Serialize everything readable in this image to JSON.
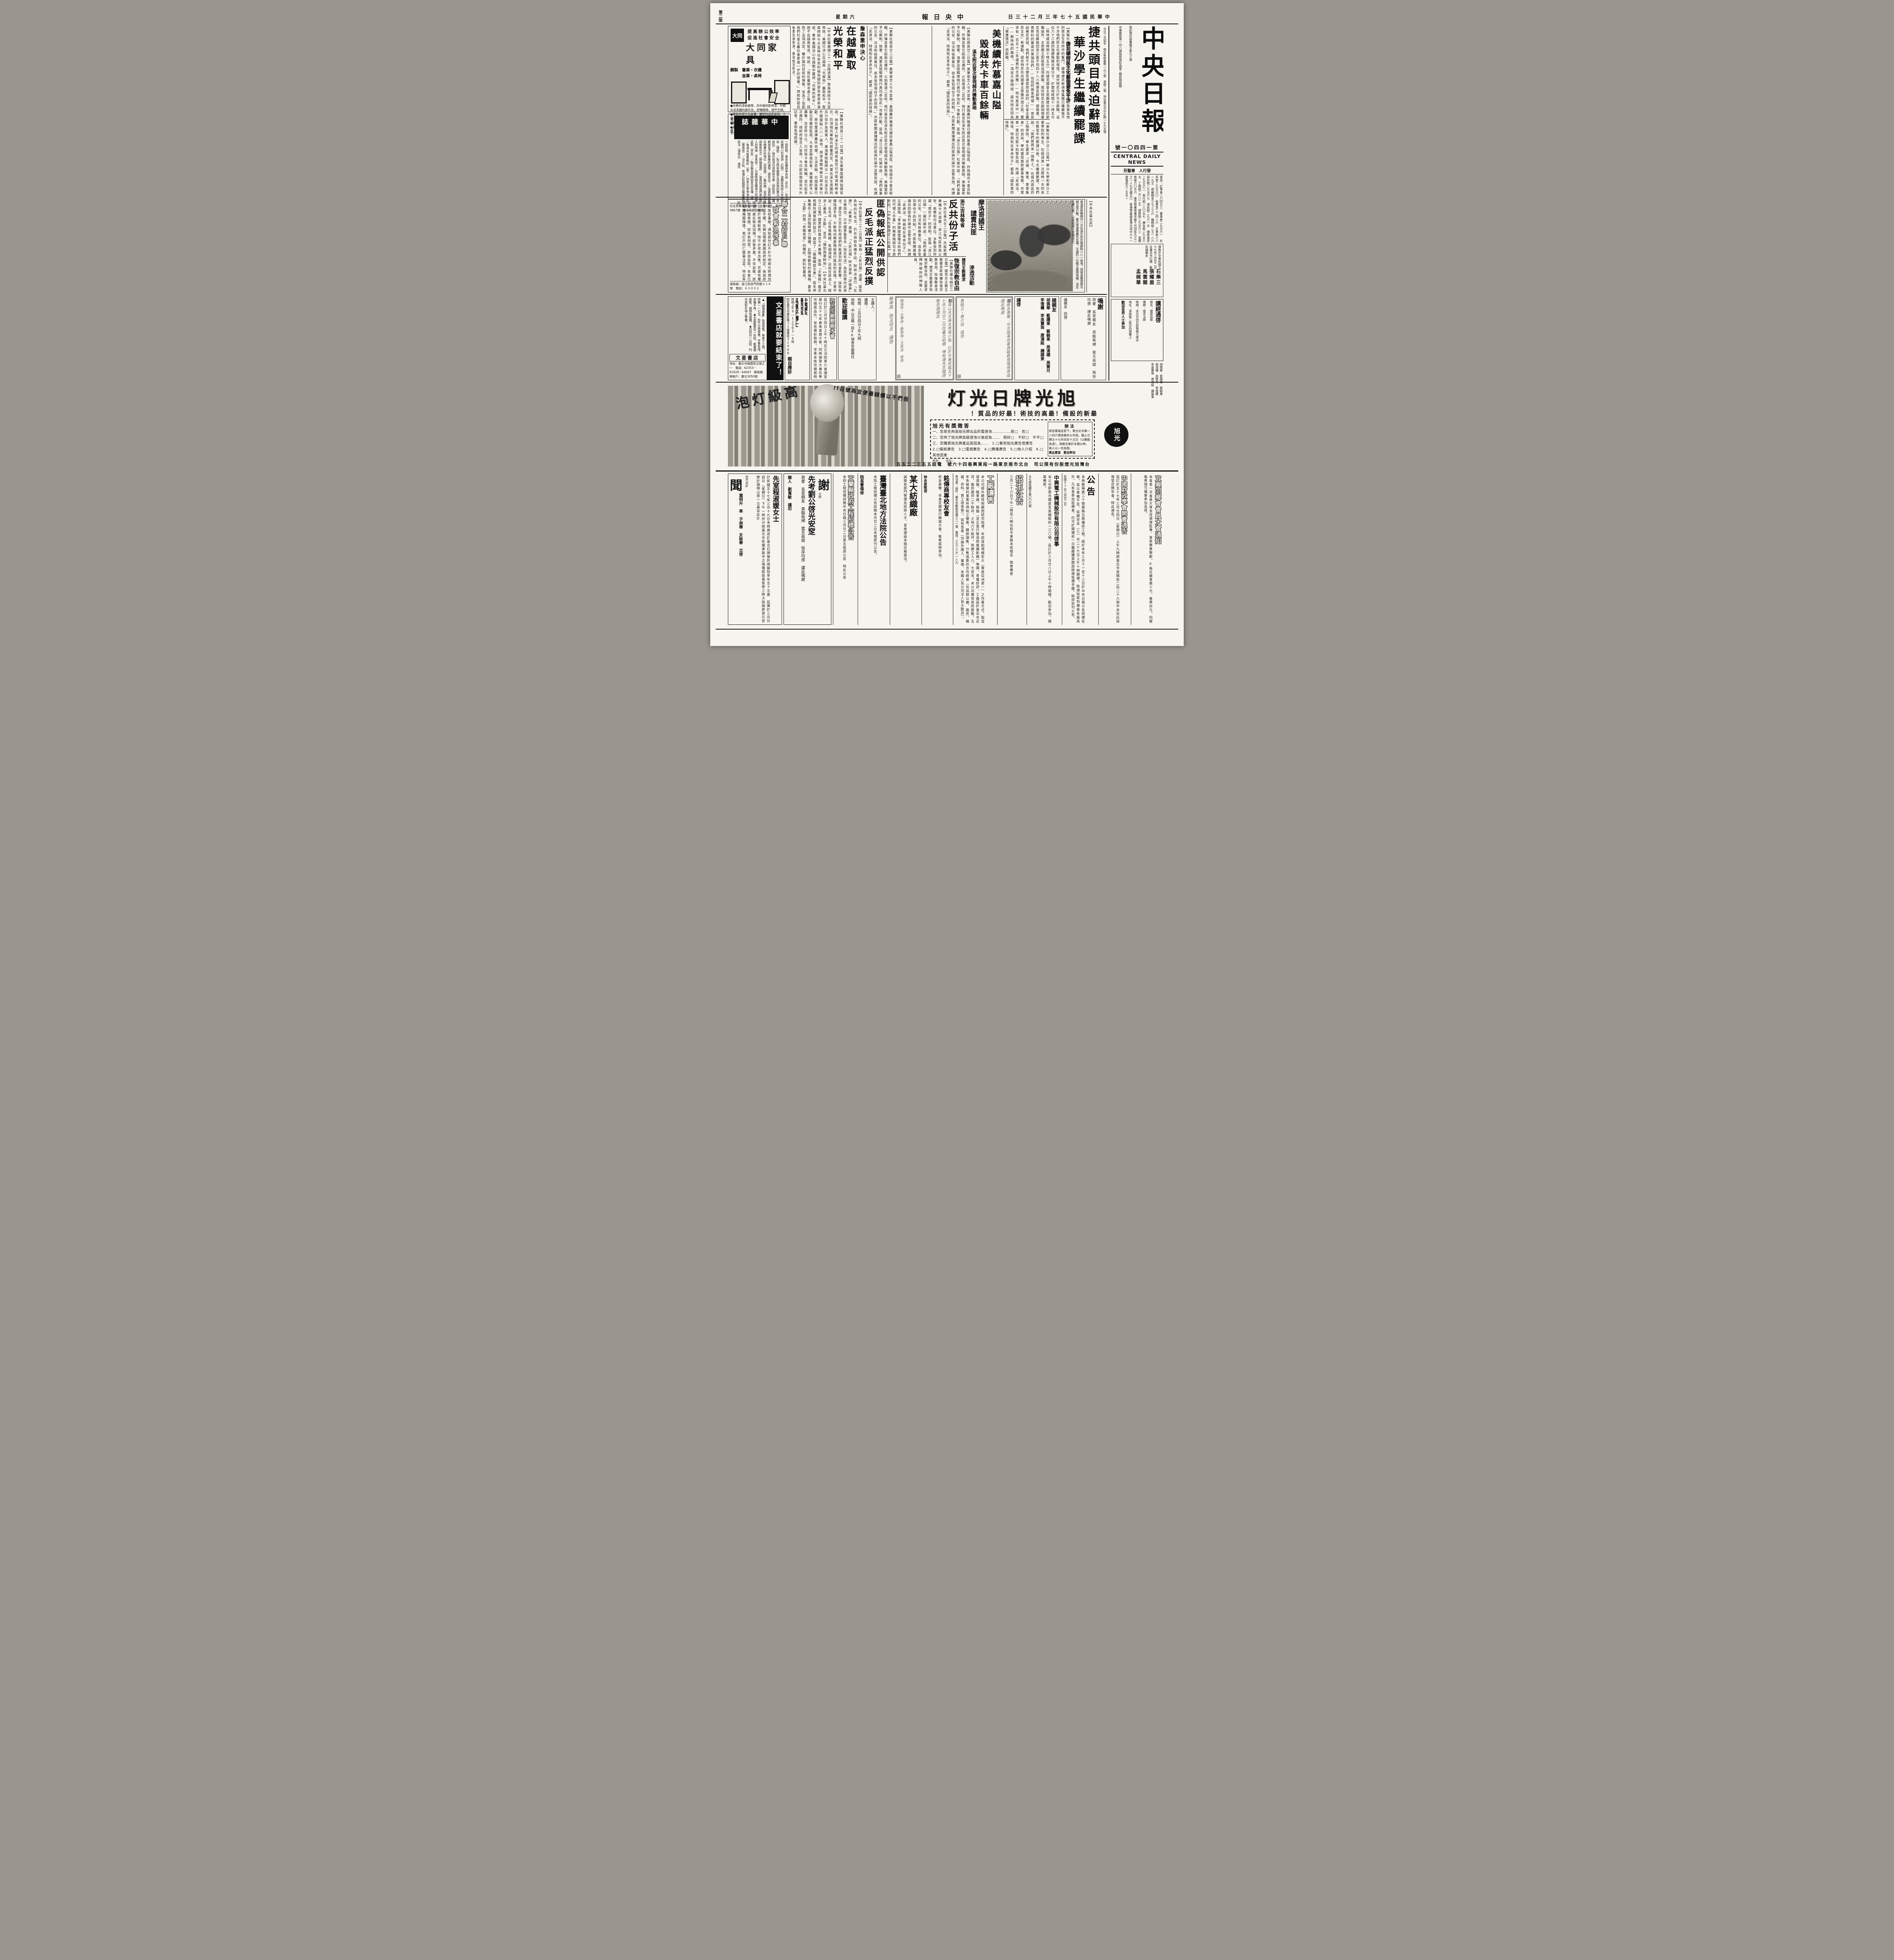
{
  "meta": {
    "page": "第二版",
    "weekday": "星期六",
    "paper": "中央日報",
    "date": "中華民國五十七年三月二十三日"
  },
  "masthead": {
    "title": "中央日報",
    "reg1": "登記證內版臺報字第九三號",
    "reg2": "中華郵政第一四八號執照登記為第二類新聞紙類",
    "issue": "第一四四〇一號",
    "english": "CENTRAL DAILY NEWS",
    "publisher": "發行人　曾聖芬",
    "phones": "電話：訂事會二六四五三　董事會二九五六一　社長室二九五六〇　秘書室二二四八六　主筆室三八一九五　總編輯室三七三三六　編輯組二五一八六　採訪組二九五六七　通訊組二七六一五　總經理室二九五六二　發行組二八〇五七　廣告組二九五六五　工務組二六八二五　總務組二九五六三　電報掛號六〇五六　東京營業處東京都千代田區九之二之一八丸大樓五〇　香港營業處香港大道中六十一號電話五一五五二",
    "price": "今日二大張半　每份售新臺幣一元二角　港幣二毫　地址臺北市中正路一七九五號",
    "engage_body": "謹詹於中華民國五十七年三月廿二日在臺北市訂婚　敬告諸親友",
    "engage_names": "石樂三　張耀眉　馬雲閣　孟婉華",
    "sutra_title": "講經通啓",
    "sutra_l1": "經名：維摩詰經",
    "sutra_l2": "講師：南亭法師",
    "sutra_l3": "時間：本月廿四日起每晚七時半",
    "sutra_l4": "地址：濟南路二段廿四號樓上",
    "sutra_l5": "歡迎各界人士參加"
  },
  "stories": {
    "lead": {
      "h1": "捷共頭目被迫辭職",
      "h2": "華沙學生繼續罷課",
      "sub": "捷共標榜民主化蘇俄避免干涉",
      "body": "【美聯社布拉格廿二日電】捷克總統諾伏特尼已放棄為他的政治生命所作的奮鬥，據傳捷共新領導集團已獲蘇俄不干涉他們民主化運動的保證，諾伏特尼乃於今天辭職。這位六十三歲的強硬路線共黨分子，於當地時間十一時五分（格林威治時間十時五分）向捷克國會主席團提出他的辭職函件，主席團立即接受這項辭職。諾伏特尼在副總理塞尼克從蘇俄回來之後不到四十八小時便告辭職。據報導，莫斯科的最高共黨頭目們——包括柯錫金總理——曾告訴塞尼克說，他們將不干涉捷克澈底而自由的「社會主義民主化」新運動。諾伏特尼在向國會主席團作證之前，要求有一百五十二名議員的主席團——他也是其中一員——解除他的職務。一項官方聲明說：諾伏特尼因為「健康情況」而辭職。",
      "body2": "【美聯社華沙廿二日電】華沙大學和華沙工業學院的學生，在經過第一次歷時一天的坐在教室中的罷課以後，今天繼續罷課。他們說：「我們將再來一個晚上。」在城內兩區的工程學院，學生要求「言論、集會、羣眾集會」的自由。學校當局面對嚴重後果，共黨第一書記戈默卡則警告說，所謂「走資派、叛徒、特務和反革命份子」都是「國民黨的特務」。"
    },
    "viet": {
      "h1": "美機續炸慕嘉山隘",
      "h2": "毀越共卡車百餘輛",
      "sub": "溪生附近首次發現越共機動高砲",
      "body": "【美聯社西貢廿二日電】美軍發言人今天宣佈：美國轟炸機連日續炸慕嘉山隘地區，炸毀越共卡車百餘輛，炸彈並曾引起兩次爆炸，火焰高達二百呎。飛行員並在溪生附近首次發現越共機動高砲，美機當即予以壓制。陸軍、海軍及陸戰隊飛行員均參加此一攻擊行動。匪偽「浙江日報」社論中說：「我們省裏的公安、司法和檢察單位，很多受到壞份子的控制。」共匪新聞廣播播出的匪偽社論中並警告說，所謂「走資派、特務和反革命份子」，都是「國民黨的特務」。"
    },
    "johnson": {
      "kicker": "詹森重申決心",
      "h1": "在越贏取",
      "h2": "光榮和平",
      "body": "【中央社華盛頓二十一日路透電】詹森總統今天宣佈說：美國已決心在越南「光榮地」贏取和平。詹森總統今天宣佈任命克利福為國防部長後發表演說，重申美國決心在越戰中贏得「光榮的和平」，絕不自越南後退。他說：「我在審慎考慮之後，採取了這項決定。鑒於國內目前的情勢，並為了協助我們社會主義社會更進一步的發展。」總統昨接見美軍前線將領，垂詢戰況甚詳。"
    },
    "misc1": "【美聯社西貢二十一日電】溪生美軍陸戰隊指揮官說，詢及敵人對溪生的威脅是否已可能減輕時表示，仍須視共軍砲兵部署而定，共軍在溪生周圍的兵力估計為兩萬人。美海軍陸戰隊廿一日在溪生的外圍據點八八一高地，用望遠鏡偵察北越共軍行動，替空軍選擇轟炸目標。又消息稱，北越匪軍行動已受嚴密監視，凡有意圖進犯者，美機當即予以轟擊，及至昨日止，已炸毀卡車百餘輛，並引起多次爆炸。總統府發言人宣佈，今日起恢復接見中外記者，垂詢各項問題。",
    "redsplit": {
      "h1": "匪偽報紙公開供認",
      "h2": "反毛派正猛烈反撲",
      "body": "【中央社臺北二十二日電】匪偽「人民日報」透露：匪區各地的反毛派，仍在採取各種手段，對林派進行「反撲」。「新華社」廣播：「人民日報」昨天發表「評論員」文章指出，以中國黑魯雪夫（指反毛派）為首的黨內走資派，還在千方百計利用他們所能達到的社會影響，採取各種陰謀手段，不斷地向無產階級進行瘋狂的反撲。文章中說：反毛派「在各條戰線、各個領域」目前在政治上、經濟上最為「主動」，並且「猶如兩軍餘地」。【中央社臺北廿二日電】據莫斯科電台今天廣播，匪偽「文匯報」最近根據所謂幫助的指示，撰寫了「篇編輯部文章」，匪毛林集團在上海的臨時權力機構，此間收聽到的廣播稱，最為「主動」的是「依賴思想」的種籽、肥料和農具。"
    },
    "anti": {
      "kicker": "浙江吉林等省",
      "h1": "反共份子活躍",
      "body": "【中央社臺北廿二日電】共匪新聞廣播今天透露：浙江地區匪偽公安、檢察和司法單位，多數受到所謂「壞份子」的控制。匪偽「浙江日報」一篇社論中說：「我們省裏的公安、司法和檢察單位，很多受到壞份子的控制。」共匪新聞廣播播出的匪偽社論中並警告說，所謂「走資派、特務和反革命份子」，正與匪偽「革命路線當權派和他們的代理人手裏」的無產階級司令部對抗。【中央社香港廿二日電】吉林省共匪毛林派於三月六日草草成立所謂「革命委員會」後，不但反毛和反共活動並未停止，甚至連毛林派內部也遭受三害——「派性主義、經濟主義和無政府主義」的嚴重困擾。據最近運抵香港的三月十一日的匪偽「吉林日報」說：目前匪偽「壞份子」的檢察單位，很多受到「特務」的控制。"
    },
    "church": {
      "kicker": "捷克主教要求",
      "h1": "恢復宗教自由",
      "body": "【美聯社維也納廿二日電】捷克天主教主教要求新政權恢復宗教自由，恢復教會活動。捷克主教要求恢復宗教自由，並要求釋放被拘的神職人員。"
    },
    "morocco": {
      "l1": "摩洛哥國王",
      "l2": "譴責共匪",
      "l3": "滲透活動",
      "src": "【中央社臺北訊】"
    },
    "photo": {
      "caption": "美海軍陸戰隊廿一日在溪生的外圍據點八八一高地，用望遠鏡偵察北越共軍行動，替空軍選擇轟炸目標。左邊的一位戰士展閱地圖，決定目標位置。（合眾國際社電傳照片）"
    }
  },
  "ads": {
    "datong": {
      "s1": "提高辦公效率",
      "s2": "促進社會安全",
      "brand": "大同家具",
      "logo": "大同",
      "sub1": "鋼製　書庫・衣櫃",
      "sub2": "金庫・桌椅",
      "b1": "●完善的漆前處理，赤外線烘乾烤漆，外觀永呈美麗的銀灰色，舒暢眼睛，絕不生銹。",
      "b2": "●嶄新的現代化設備，嚴密的品質管制，大量生產。",
      "b3": "●獨特優越的意匠設計，使用方便。",
      "b4": "●鋼板最厚長年耐用，特製號碼鎖方便保管。"
    },
    "zh": {
      "title": "中華雜誌",
      "issue": "三月號　本社",
      "items": [
        "一個對照：黃金投機與爭自由（本社）",
        "從小張伯倫到小甘迺迪（石明）",
        "波蘭民族詩人米奇維茲（陳節）",
        "對立院有關費正清質詢的看法（徐高阮）",
        "復社與清代思想與文學（胡秋原）",
        "邏輯與電子計算機的選用（唐寧治）",
        "道德與科學在繪畫中的地位（何懷碩）",
        "塞尚論：自然形式與藝術形式（謝曉基譯）",
        "當我知道我們是中國人的時候（李篤恭）",
        "日據時期宜蘭地方的精神武裝（李安）",
        "聯合報為美國姑息派宣傳（盧）",
        "香港共匪暴動記（客）",
        "加拿大雪地淘金記（陳再思）",
        "洪炎秋、曾湘石對國語日報產權的說法（湯若谷）　通訊"
      ],
      "foot": "社址景美萬慶街58號　全年60元　郵撥4867號　懷寧街新亞代售"
    },
    "lian": {
      "t1": "聯合二村訂戶聯",
      "t2": "誼會緊急啓事",
      "body": "聯和故技重施，通知部份訂戶於今明兩天辦理加價承諾手續。先稱加價經美國政府核定，後說該公司鑒於核價較高，特不計成本出售。究誰有權核價？誰在製造加價？前後矛盾，不攻自破。該公司一錯再錯，如涉有刑責，咎由自取。本會已向有關機關陳情，希訂戶同仁鄭重注意，特此奉告。",
      "contact": "連絡處：晉江街金門別墅４１８號　電話：６３００２"
    },
    "wen": {
      "strip": "文星書店就要結束了！",
      "b1": "▲「胡適選集」恢復發售，每套十三冊，特價一一七元，恕不分冊零賣，存書有限，良機不再。",
      "b2": "▲全部圖書從一折起，都廉價拋售，請趕快選購。",
      "b3": "▲自四月一日起，門市部對外停止營業。",
      "store": "文星書店",
      "addr": "地址：臺北市峨眉街五號之一　電話：62353・61928・64047　郵政劃撥帳戶：臺北3050號"
    },
    "acu": {
      "l1": "中國鍼灸",
      "l2": "醫院院長",
      "name": "吳惠平博士",
      "l3": "親自應診",
      "hours": "時間上午9—12下午3—6時",
      "addr": "院址臺北市康定路33號電話32468"
    },
    "wu": {
      "title": "武氏宗親懇親大會",
      "body": "茲訂於三月廿四日上午十時在立法院第六會議室舉行五十七年春季會員大會，同時頒發大專在學宗親獎品外，並有摸彩助興，至希本姓宗親屆時參加。此啓"
    },
    "lec": {
      "l1": "主講人：",
      "l2": "講題：",
      "l3": "時間：三月廿四日上午九時",
      "l4": "地點：中山北路一段46號青年服務社",
      "foot": "歡迎聽講"
    },
    "scr": {
      "text": "蘇孝英　張玉培五　謹啓"
    },
    "wed1": {
      "body": "彭青山先生長女秀英小姐　訂於中華民國五十七年三月廿二日在臺北結婚　傅有灌先生福證　敬告諸親友",
      "sign": "翰瑞牧・左學修・鄭擎城・王家浚　敬啓"
    },
    "wed2": {
      "body": "諸親友惠鑒：兒女婚事荷蒙賁臨觀禮隆情厚誼謹此鳴謝",
      "sign": "賈翹立・蔡介成　謹啓"
    },
    "thanks2": {
      "title": "諸親友",
      "names": "胡佩華　藍護東　蔡毓東　周清標　周賀月　李復穠　李吳寶珠　唐湯銘　譚謨東",
      "sign": "謹啓"
    },
    "thanks3": {
      "title": "鳴謝",
      "body": "荷蒙　長官親友　賁臨執紼　雲天高誼　歿存均感　謹此鳴謝",
      "sign": "諸親友　同啓"
    },
    "xu": {
      "arc1": "高級灯泡",
      "arc2": "我們不以價錢最便宜為號召!!",
      "title": "旭光牌日光灯",
      "slogan": "最新的設備！最高的技術！最好的品質！",
      "quiz": "旭光有獎徵答",
      "q1": "一、您是否用過旭光牌出品的電燈泡……………是□　否□",
      "q2": "二、您用了旭光牌高級燈泡以後認為……　很好□　不好□　平平□",
      "q3": "三、您購買旭光牌產品是因為……　1.□看到旭光廣告塔廣告",
      "opts": "2.□報紙廣告　3.□電視廣告　4.□廣播廣告　5.□他人介紹　6.□其他因素",
      "how": "辦法",
      "howbody": "將答案填妥剪下，寄台北市第一八四六號信箱本公司收。截止日期五十七年四月十五日（以郵戳為憑）。得獎名單於本報公佈，每人以一份為限。",
      "prize": "獎品豐富　歡迎參加",
      "namefield": "姓名：　　住址：",
      "logo": "旭光",
      "company": "台灣旭光燈股份有限公司　台北市南京東路一段東興巷四十六號　電話五五三二二五五"
    }
  },
  "bottom": {
    "c1": {
      "big": "聞",
      "title": "先室程淑媛女士",
      "note": "恕不另訃",
      "body": "於民國五十七年三月十九日未時病逝於臺北石牌榮民總醫院享年五十五歲　茲擇於三月廿四日（星期日）下午一時卅分假臺北市民權東路市立殯儀館設奠家祭三時大殮隨即發引安葬於陽明山第一公墓哀此訃",
      "sign": "葉明升　率　子昶華　女詠華　泣啓"
    },
    "c2": {
      "big": "謝",
      "kicker": "日昨",
      "title": "先考劉公啓光安窆",
      "body": "荷蒙　長官親友　賁臨執紼　雲天高誼　歿存均感　謹此鳴謝",
      "sign": "棘人　劉寬敏　謹叩"
    },
    "c3": {
      "title": "宜蘭縣政府工程招標公告",
      "body": "本府工程招標詳閱中央日報三月廿二日第五版原公告　特此公告"
    },
    "c4": {
      "title": "臺灣臺北地方法院公告",
      "body": "本院工程招標公告詳閱本月廿二日本報原刊公告。",
      "sign": "院長曹偉修"
    },
    "c5": {
      "title": "某大紡織廠",
      "body": "誠徵各部門管理及技術人才，意者請函本報信箱面洽。"
    },
    "c6": {
      "title": "銘傳商專校友會",
      "body": "校友惠鑒：本會定期舉行聯誼大會，敬希屆時參加。",
      "sign": "林永泉敬啓"
    },
    "c7": {
      "title": "工廠讓售",
      "body": "本公司經外籍技術顧問研究指導，年前首創規模宏大（實係亞洲第一）之作業方式，製造望遠鏡、瞄準器、稜鏡（並正進行製造照像攝影機）等類，普獲好評。工廠設於臺北市近郊，廠房建坪二千餘坪，土地六千餘坪，熟練工人六、七百名。本公司獲有政府獎勵，五年免徵營利事業所得稅之優惠。願即讓售、分售或委託合作經營（包括辦公廳、廠房、機器、存料、員工宿舍等），如有意者（勿論外國人、華僑、本國人及公司法人皆大歡迎）。",
      "sign": "商洽處：函件：臺北市郵政信箱三二一號　電話：三七二八六—八九"
    },
    "c8": {
      "title": "招生公告",
      "body": "三月二十六日下午二時至八時在和平東路本校報名　簡章備索"
    },
    "c9": {
      "title": "中興電工機械股份有限公司啓事",
      "body": "本公司即需光鐵皮及黑鐵板約一三〇噸，茲訂於三月廿八日上午十時開標，歡迎參加，標單備索。",
      "sign": "五七興陸購字第〇〇六號"
    },
    "c10": {
      "title": "公告",
      "body": "本局衡陽路二十號建築五層樓房工程，經於本年三月十一至十三日於中央日報公告招標在案。茲以準備不及，延期至本（三）月二十七日上午十時開標。除通知寄到標單各廠商外，凡有意參加投標者，仍可於開標前一日繼續購買圖說辦理投標手續。餘詳前刊公告。",
      "sign": "民國57年三月廿二日"
    },
    "c11": {
      "title": "中國財政學會開會通告",
      "body": "茲訂於五十七年三月廿四日（星期日）上午九時假臺北市貴陽街二段二十六號中央信託局禮堂召開年會，特此通告。"
    },
    "c12": {
      "title": "宜興同鄉會會員大會通知",
      "body": "本會第一次會員大會並改選理監事，會後聚餐聯歡。②每位繳會費十元、餐費卅元。同鄉敬希撥冗攜眷參加為荷。"
    }
  }
}
